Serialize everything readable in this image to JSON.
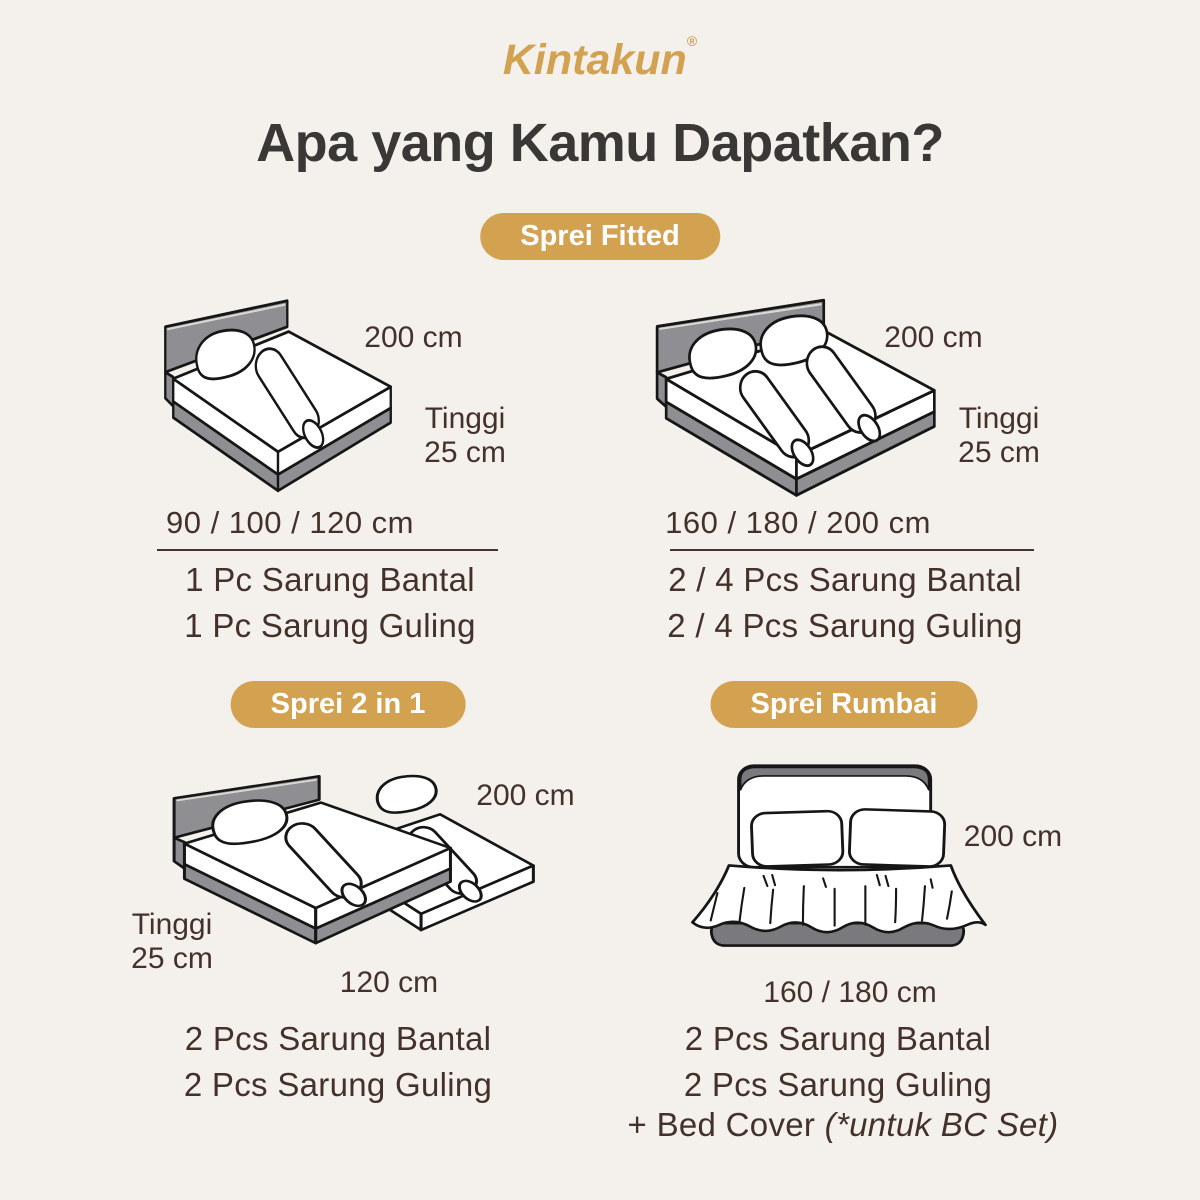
{
  "brand": {
    "logo_text": "Kintakun",
    "registered_mark": "®"
  },
  "title": "Apa yang Kamu Dapatkan?",
  "colors": {
    "background": "#f4f1ed",
    "gold_accent": "#d3a251",
    "title_text": "#3a3837",
    "body_text": "#44312a",
    "bed_frame_gray": "#8f8f93",
    "bed_base_dark_gray": "#7a7a7e",
    "illustration_outline": "#161616"
  },
  "sections": [
    {
      "badge": "Sprei Fitted",
      "variants": [
        {
          "length_label": "200 cm",
          "height_label": "Tinggi",
          "height_value": "25 cm",
          "widths_label": "90 / 100 / 120 cm",
          "items": [
            "1 Pc Sarung Bantal",
            "1 Pc Sarung Guling"
          ]
        },
        {
          "length_label": "200 cm",
          "height_label": "Tinggi",
          "height_value": "25 cm",
          "widths_label": "160 / 180 / 200 cm",
          "items": [
            "2 / 4 Pcs Sarung Bantal",
            "2 / 4 Pcs Sarung Guling"
          ]
        }
      ]
    },
    {
      "badge": "Sprei 2 in 1",
      "length_label": "200 cm",
      "height_label": "Tinggi",
      "height_value": "25 cm",
      "widths_label": "120 cm",
      "items": [
        "2 Pcs Sarung Bantal",
        "2 Pcs Sarung Guling"
      ]
    },
    {
      "badge": "Sprei Rumbai",
      "length_label": "200 cm",
      "widths_label": "160 / 180 cm",
      "items": [
        "2 Pcs Sarung Bantal",
        "2 Pcs Sarung Guling"
      ],
      "bed_cover_prefix": "+ Bed Cover ",
      "bed_cover_note": "(*untuk BC Set)"
    }
  ]
}
